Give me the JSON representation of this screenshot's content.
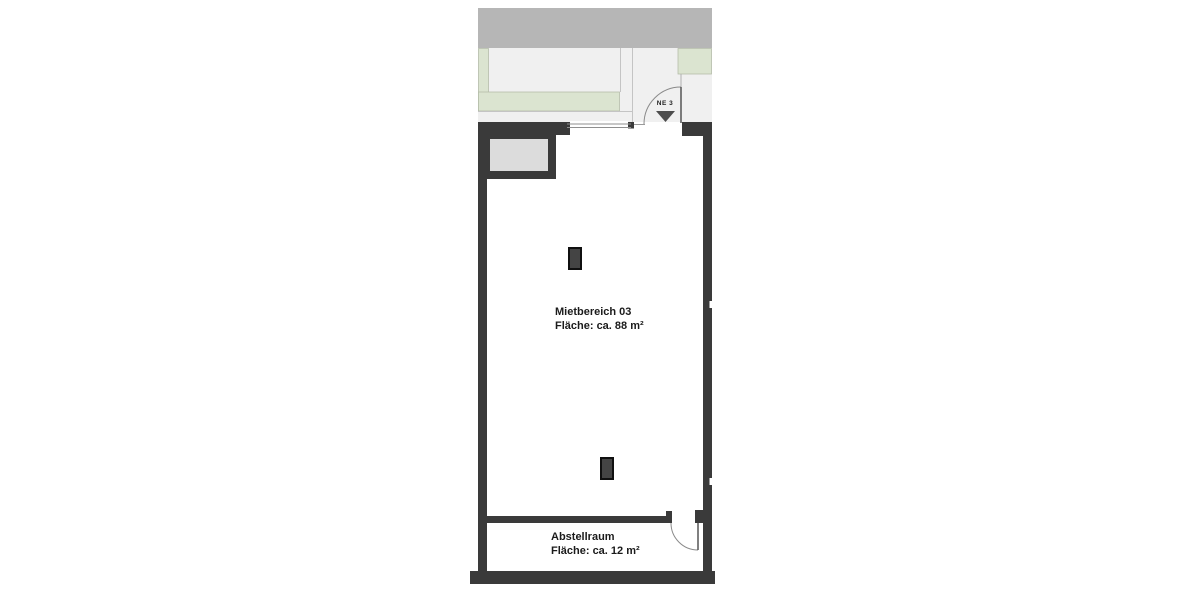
{
  "plan": {
    "entrance": {
      "label": "NE 3"
    },
    "rooms": [
      {
        "name": "Mietbereich 03",
        "area": "Fläche: ca. 88 m²"
      },
      {
        "name": "Abstellraum",
        "area": "Fläche: ca. 12 m²"
      }
    ],
    "icons": [
      {
        "name": "entrance-direction-triangle-icon",
        "glyph": "▼"
      },
      {
        "name": "door-swing-arc",
        "glyph": "quarter-circle"
      }
    ],
    "colors": {
      "wall": "#3a3a3a",
      "street_band": "#b6b6b6",
      "exterior_ground": "#f0f0f0",
      "planting_green": "#dbe4d0",
      "sidewalk": "#ebebe4",
      "shaft_fill": "#dcdcdc",
      "column": "#444444",
      "door_line": "#8a8a8a"
    }
  }
}
